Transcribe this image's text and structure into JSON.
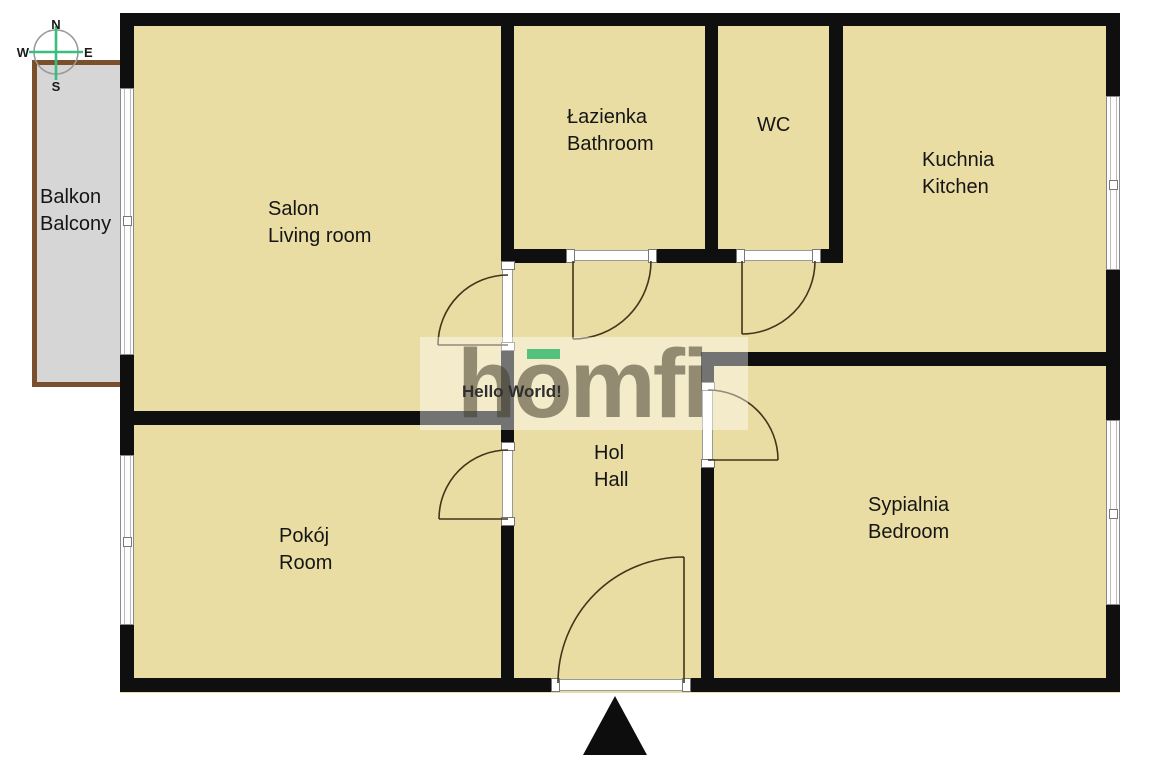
{
  "plan_title": "Apartment floor plan",
  "compass": {
    "north": "N",
    "south": "S",
    "east": "E",
    "west": "W"
  },
  "rooms": {
    "balcony": {
      "name_pl": "Balkon",
      "name_en": "Balcony"
    },
    "living_room": {
      "name_pl": "Salon",
      "name_en": "Living room"
    },
    "bathroom": {
      "name_pl": "Łazienka",
      "name_en": "Bathroom"
    },
    "wc": {
      "name_pl": "WC",
      "name_en": ""
    },
    "kitchen": {
      "name_pl": "Kuchnia",
      "name_en": "Kitchen"
    },
    "hall": {
      "name_pl": "Hol",
      "name_en": "Hall"
    },
    "room": {
      "name_pl": "Pokój",
      "name_en": "Room"
    },
    "bedroom": {
      "name_pl": "Sypialnia",
      "name_en": "Bedroom"
    }
  },
  "watermark": {
    "logo_text": "homfi",
    "overlay_text": "Hello World!",
    "accent_color": "#54c27c",
    "logo_color": "#8e8871"
  },
  "colors": {
    "floor": "#EADDA4",
    "wall": "#0f0f0f",
    "balcony_floor": "#D6D6D6",
    "balcony_border": "#7a4f2c",
    "compass_green": "#3bbd7d",
    "background": "#ffffff"
  }
}
